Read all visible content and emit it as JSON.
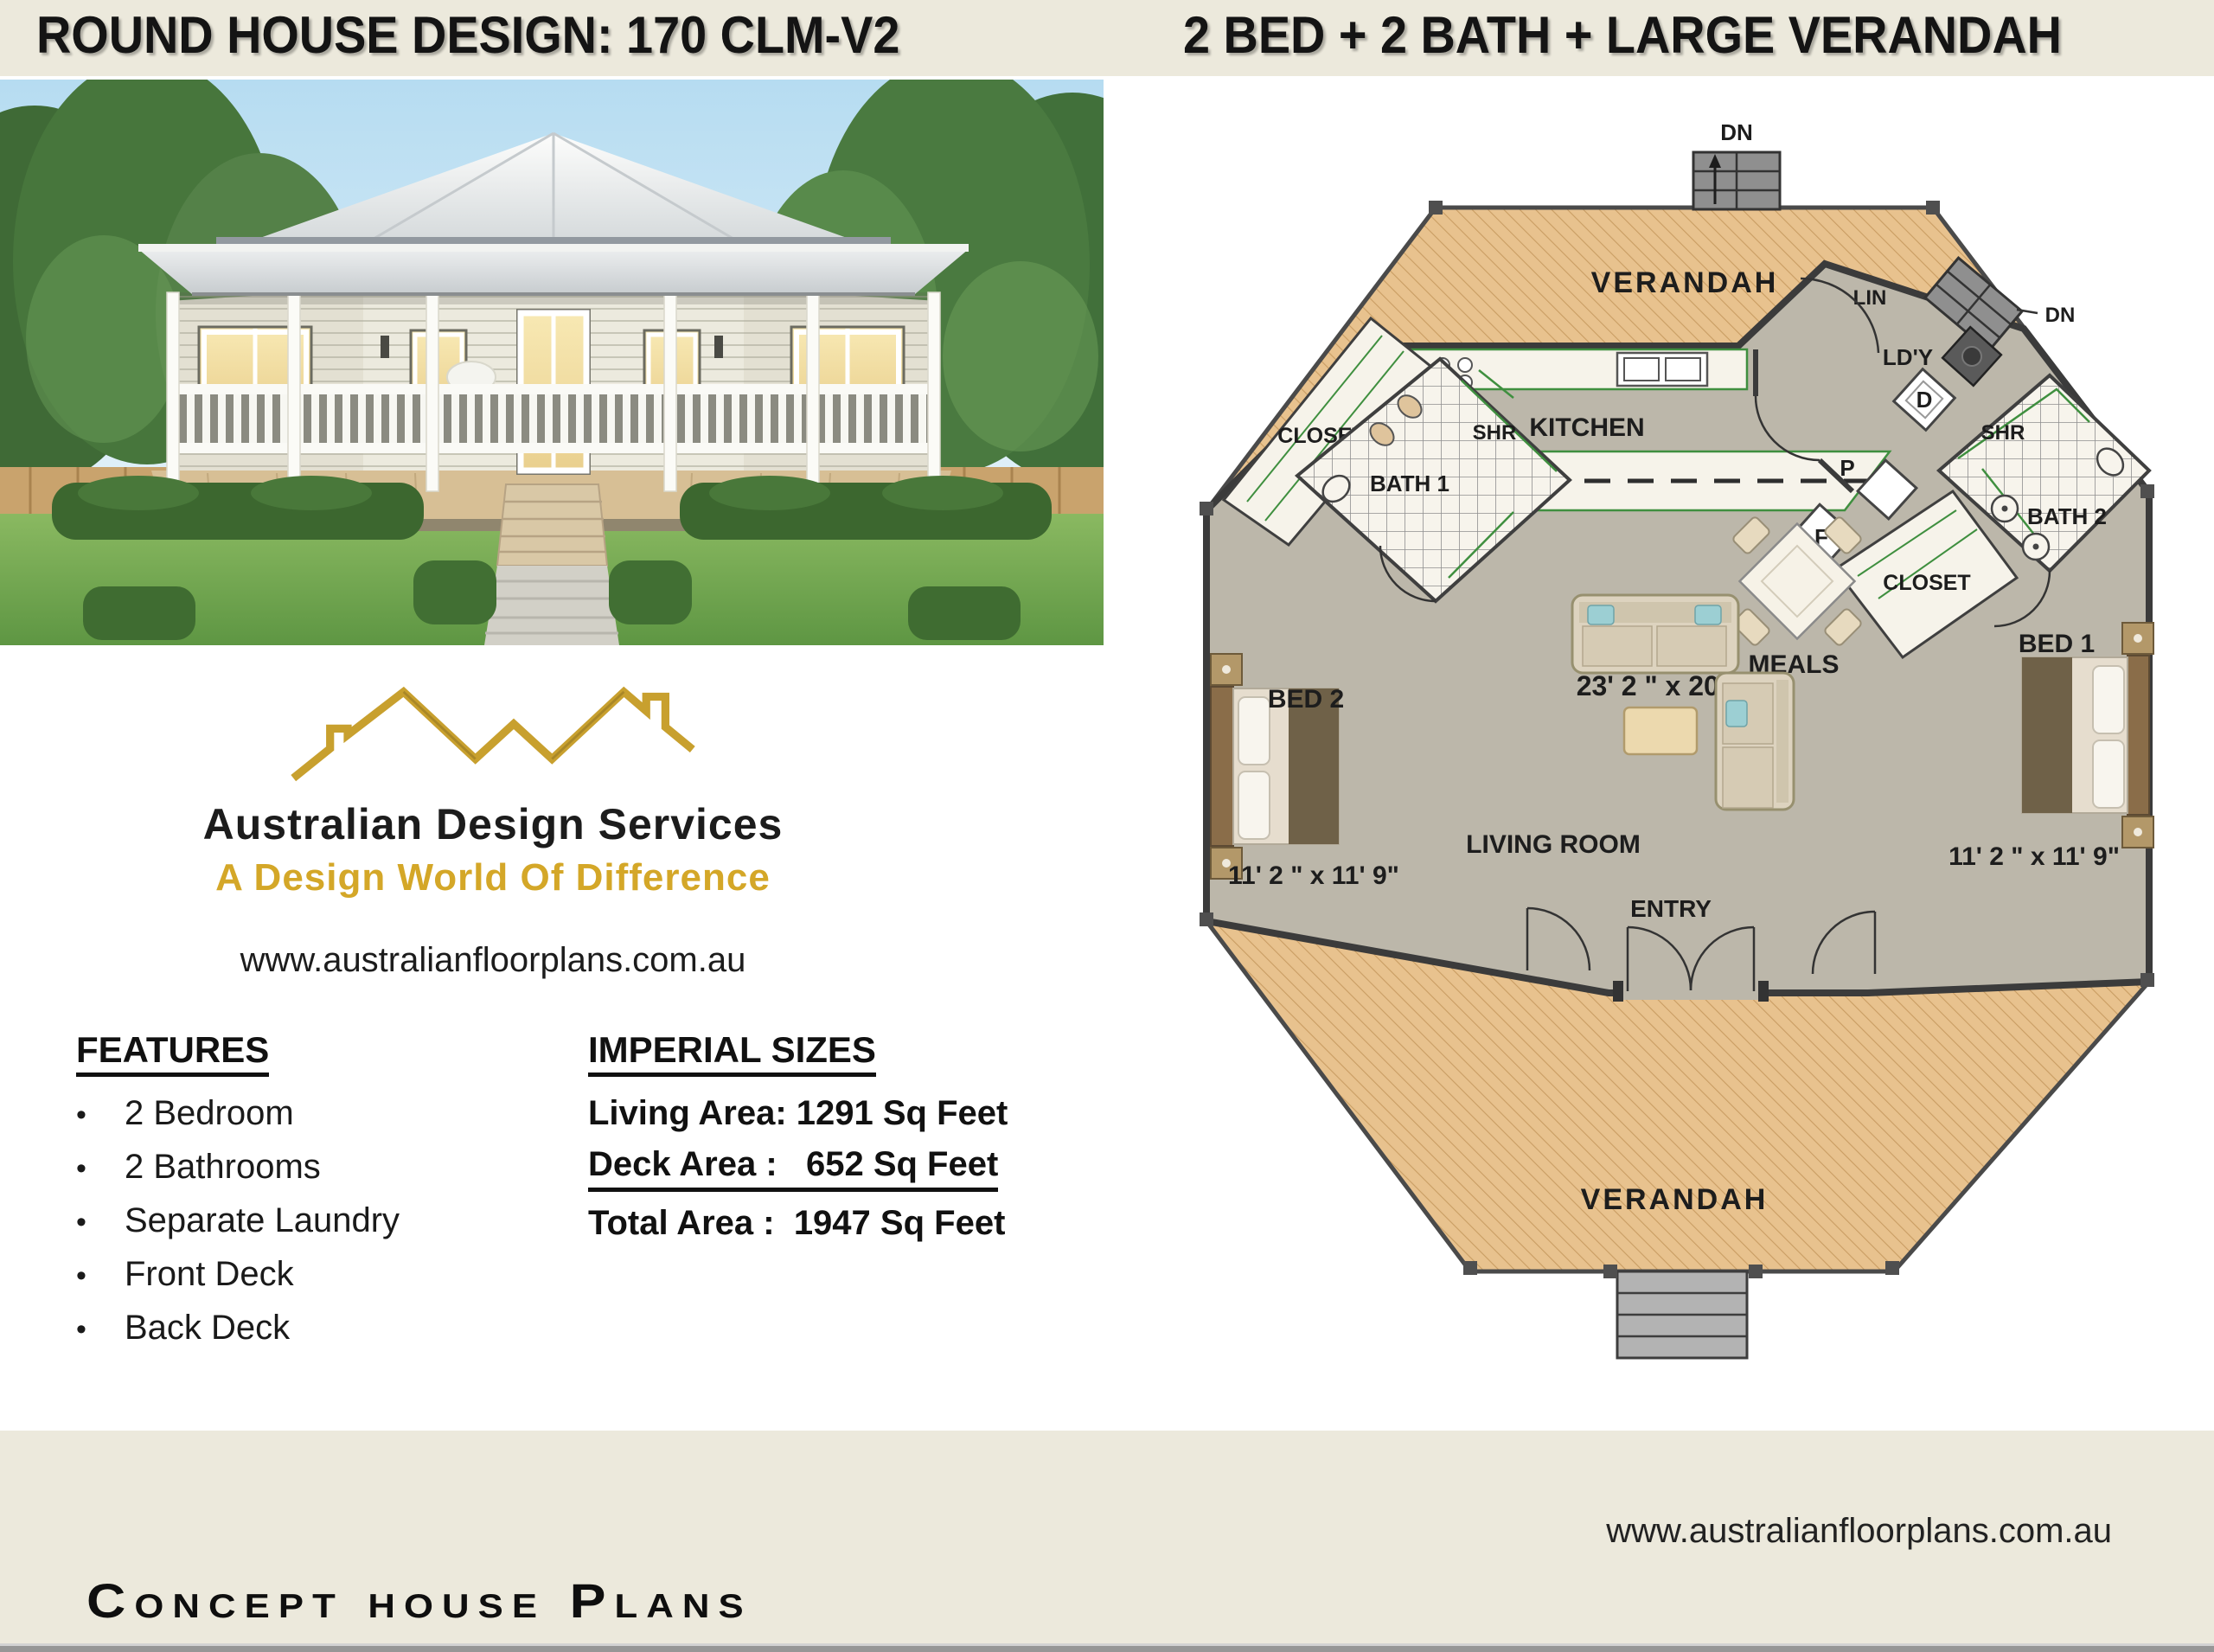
{
  "header": {
    "title_left": "ROUND HOUSE DESIGN: 170 CLM-V2",
    "title_right": "2 BED + 2 BATH + LARGE VERANDAH"
  },
  "branding": {
    "company": "Australian Design Services",
    "tagline": "A Design World Of Difference",
    "website": "www.australianfloorplans.com.au"
  },
  "features": {
    "heading": "FEATURES",
    "items": [
      "2 Bedroom",
      "2 Bathrooms",
      "Separate Laundry",
      "Front Deck",
      "Back Deck"
    ]
  },
  "imperial": {
    "heading": "IMPERIAL SIZES",
    "lines": [
      "Living Area: 1291 Sq Feet",
      "Deck Area :   652 Sq Feet",
      "Total Area :  1947 Sq Feet"
    ]
  },
  "footer": {
    "website": "www.australianfloorplans.com.au",
    "brand": "Concept house Plans"
  },
  "plan": {
    "verandah_top": "VERANDAH",
    "verandah_bottom": "VERANDAH",
    "kitchen": "KITCHEN",
    "closet_left": "CLOSET",
    "closet_right": "CLOSET",
    "bath_1": "BATH 1",
    "bath_2": "BATH 2",
    "shr_left": "SHR",
    "shr_right": "SHR",
    "bed_1": "BED 1",
    "bed_2": "BED 2",
    "bed_1_dim": "11' 2 \" x 11' 9\"",
    "bed_2_dim": "11' 2 \" x 11' 9\"",
    "living_dim": "23' 2 \" x 20' 5\"",
    "meals": "MEALS",
    "living_room": "LIVING ROOM",
    "entry": "ENTRY",
    "laundry": "LD'Y",
    "linen": "LIN",
    "dn_top": "DN",
    "dn_side": "DN",
    "cooktop": "C",
    "pantry": "P",
    "fridge": "F",
    "dryer": "D"
  },
  "colors": {
    "cream": "#ece9dc",
    "accent_gold": "#d4a728",
    "verandah_tan": "#e8c28e",
    "floor_gray": "#bcb7aa",
    "wall_dark": "#3b3b3b"
  }
}
